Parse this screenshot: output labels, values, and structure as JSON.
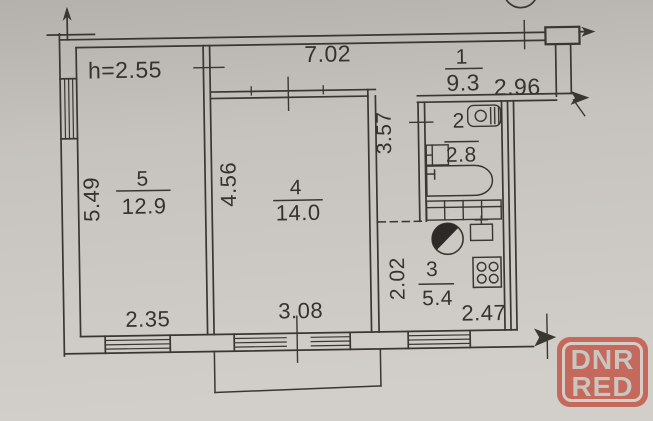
{
  "plan": {
    "ceiling_height": "h=2.55",
    "rooms": {
      "hall": {
        "number": "1",
        "area": "9.3"
      },
      "bath": {
        "number": "2",
        "area": "2.8"
      },
      "kitchen": {
        "number": "3",
        "area": "5.4"
      },
      "room4": {
        "number": "4",
        "area": "14.0"
      },
      "room5": {
        "number": "5",
        "area": "12.9"
      }
    },
    "dimensions": {
      "hall_top": "7.02",
      "entry": "2.96",
      "corridor_side": "3.57",
      "room4_side": "4.56",
      "room5_side": "5.49",
      "kitchen_side": "2.02",
      "room5_bottom": "2.35",
      "room4_bottom": "3.08",
      "kitchen_bottom": "2.47"
    }
  },
  "watermark": {
    "line1": "DNR",
    "line2": "RED",
    "badge_color": "#c4695c",
    "border_color": "#d6cec6",
    "text_color": "#c9c6c0"
  },
  "colors": {
    "paper": "#c9c6c1",
    "ink": "#3a3630"
  }
}
